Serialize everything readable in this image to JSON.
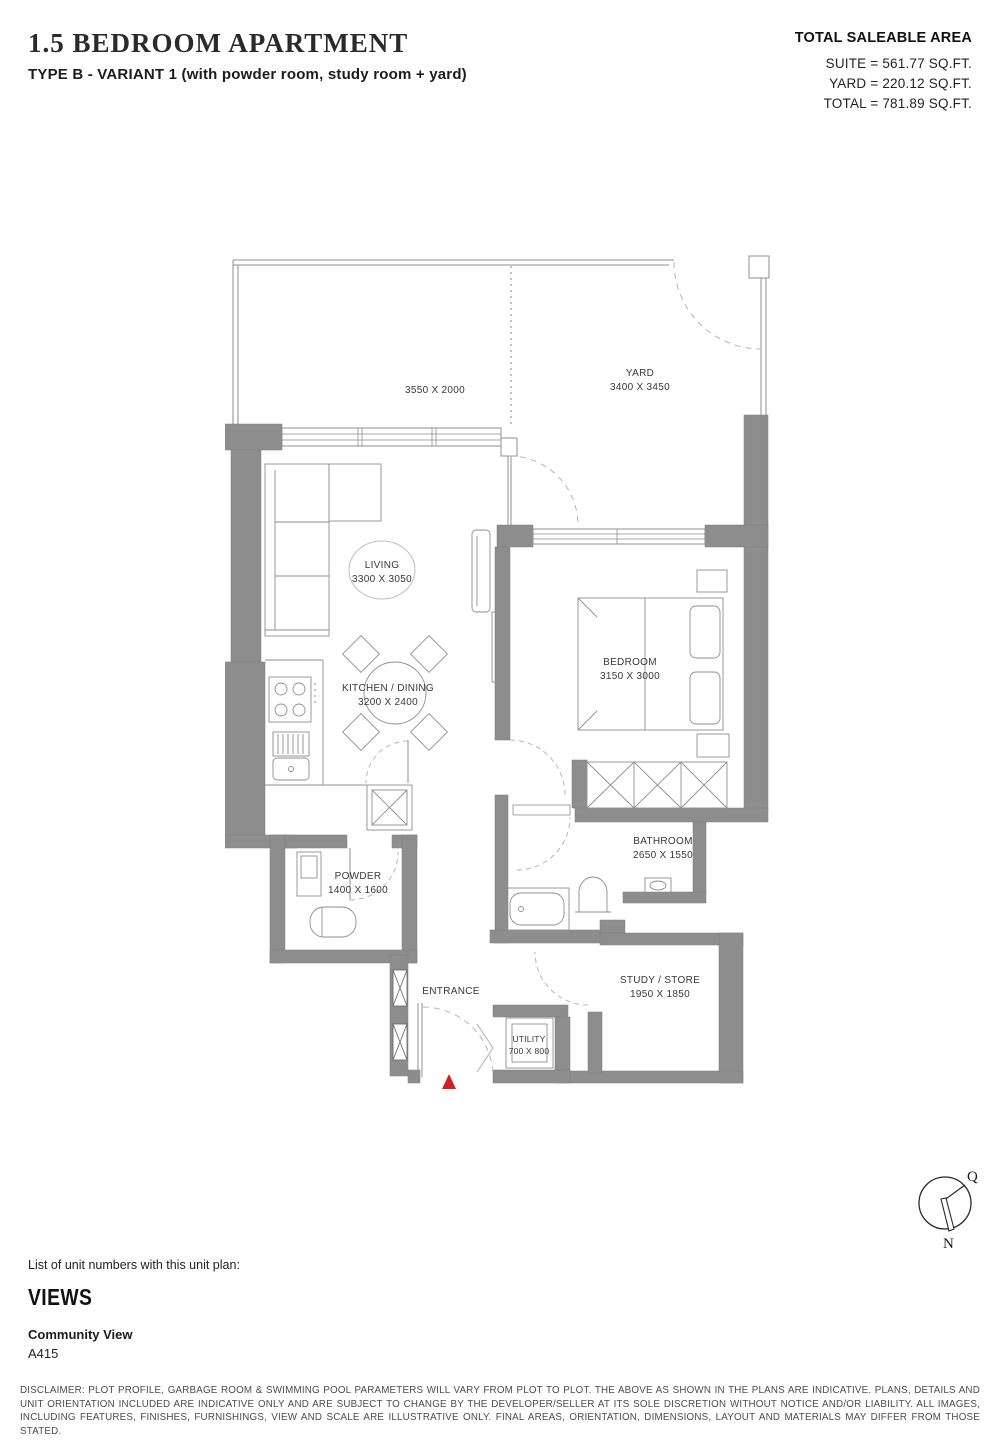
{
  "header": {
    "title": "1.5 BEDROOM APARTMENT",
    "subtitle": "TYPE B - VARIANT 1 (with powder room, study room + yard)",
    "area": {
      "heading": "TOTAL SALEABLE AREA",
      "suite": "SUITE = 561.77 SQ.FT.",
      "yard": "YARD = 220.12 SQ.FT.",
      "total": "TOTAL = 781.89 SQ.FT."
    }
  },
  "plan": {
    "rooms": {
      "terrace_dim": "3550 X 2000",
      "yard": "YARD",
      "yard_dim": "3400 X 3450",
      "living": "LIVING",
      "living_dim": "3300 X 3050",
      "kitchen": "KITCHEN / DINING",
      "kitchen_dim": "3200 X 2400",
      "bedroom": "BEDROOM",
      "bedroom_dim": "3150 X 3000",
      "bathroom": "BATHROOM",
      "bathroom_dim": "2650 X 1550",
      "powder": "POWDER",
      "powder_dim": "1400 X 1600",
      "entrance": "ENTRANCE",
      "utility": "UTILITY",
      "utility_dim": "700 X 800",
      "study": "STUDY / STORE",
      "study_dim": "1950 X 1850"
    },
    "colors": {
      "wall": "#8d8d8d",
      "entry_marker": "#d02027",
      "line": "#8f8f8f"
    }
  },
  "compass": {
    "north": "N",
    "qibla": "Q"
  },
  "footer": {
    "list_label": "List of unit numbers with this unit plan:",
    "views_heading": "VIEWS",
    "view_name": "Community View",
    "units": "A415",
    "disclaimer": "DISCLAIMER: PLOT PROFILE, GARBAGE ROOM & SWIMMING POOL PARAMETERS WILL VARY FROM PLOT TO PLOT. THE ABOVE AS SHOWN IN THE PLANS ARE INDICATIVE. PLANS, DETAILS AND UNIT ORIENTATION INCLUDED ARE INDICATIVE ONLY AND ARE SUBJECT TO CHANGE BY THE DEVELOPER/SELLER AT ITS SOLE DISCRETION WITHOUT NOTICE AND/OR LIABILITY. ALL IMAGES, INCLUDING FEATURES, FINISHES, FURNISHINGS, VIEW AND SCALE ARE ILLUSTRATIVE ONLY. FINAL AREAS, ORIENTATION, DIMENSIONS, LAYOUT AND MATERIALS MAY DIFFER FROM THOSE STATED."
  }
}
